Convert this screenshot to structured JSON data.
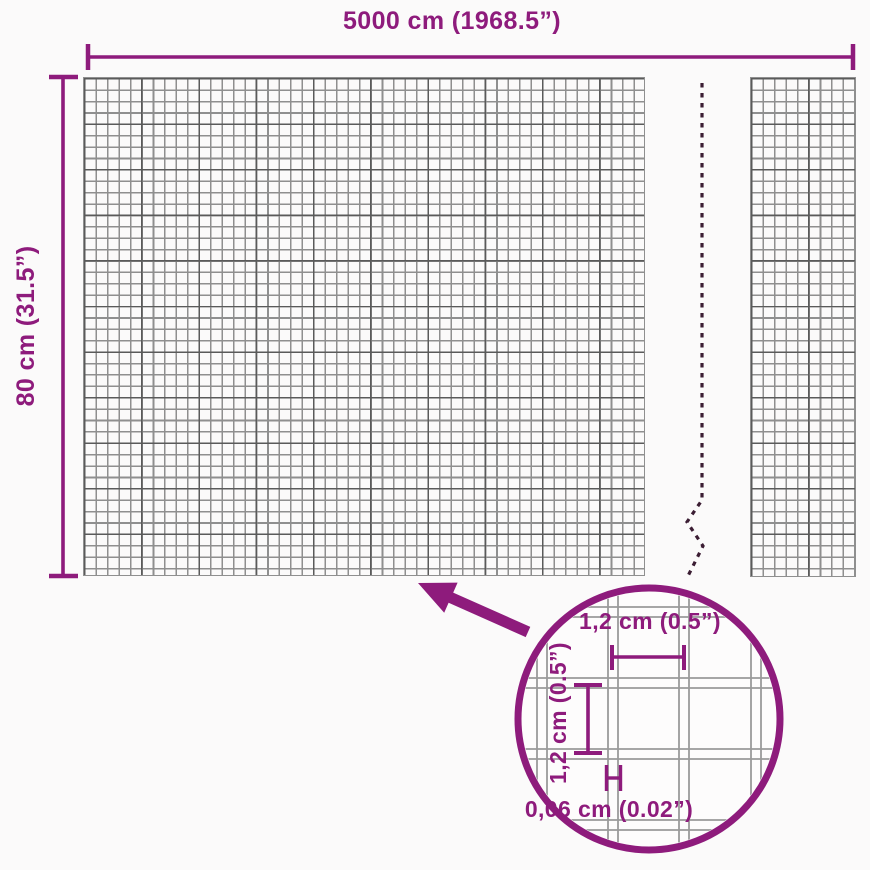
{
  "dimensions": {
    "width_label": "5000 cm (1968.5”)",
    "height_label": "80 cm (31.5”)"
  },
  "detail": {
    "cell_width_label": "1,2 cm (0.5”)",
    "cell_height_label": "1,2 cm (0.5”)",
    "wire_thickness_label": "0,06 cm (0.02”)"
  },
  "icons": {
    "magnifier_circle": "circle-outline-lens",
    "zoom_arrow": "thick-arrow-up-left",
    "break_line": "vertical-dashed-zigzag"
  },
  "colors": {
    "accent": "#8e1b7c",
    "dash": "#3b1d33",
    "mesh": "#8f8f8f",
    "mesh_dark": "#5a5a5a",
    "wire": "#9a9a9a",
    "bg": "#fbfafa",
    "bg2": "#fdfcfc"
  }
}
